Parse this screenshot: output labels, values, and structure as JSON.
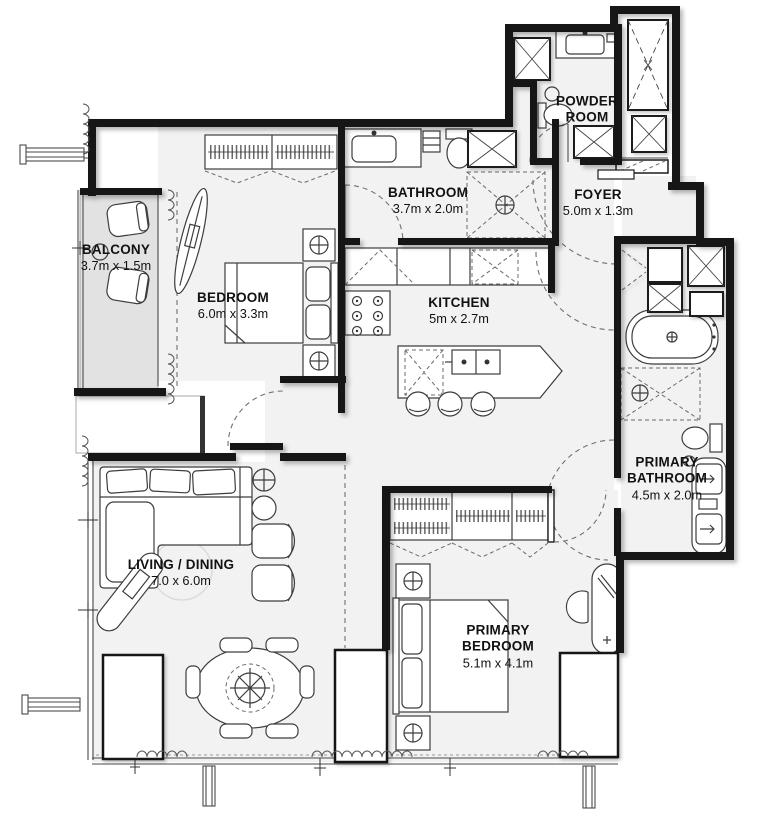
{
  "plan": {
    "title": "Apartment floor plan",
    "rooms": [
      {
        "id": "balcony",
        "name": "BALCONY",
        "dims": "3.7m x 1.5m"
      },
      {
        "id": "bedroom",
        "name": "BEDROOM",
        "dims": "6.0m x 3.3m"
      },
      {
        "id": "bathroom",
        "name": "BATHROOM",
        "dims": "3.7m x 2.0m"
      },
      {
        "id": "kitchen",
        "name": "KITCHEN",
        "dims": "5m x 2.7m"
      },
      {
        "id": "powder-room",
        "name": "POWDER ROOM",
        "dims": ""
      },
      {
        "id": "foyer",
        "name": "FOYER",
        "dims": "5.0m x 1.3m"
      },
      {
        "id": "primary-bathroom",
        "name": "PRIMARY BATHROOM",
        "dims": "4.5m x 2.0m"
      },
      {
        "id": "living-dining",
        "name": "LIVING / DINING",
        "dims": "7.0 x 6.0m"
      },
      {
        "id": "primary-bedroom",
        "name": "PRIMARY BEDROOM",
        "dims": "5.1m x 4.1m"
      }
    ],
    "colors": {
      "wall": "#161616",
      "floor": "#f2f2f2",
      "balcony_floor": "#e2e2e2",
      "furniture_line": "#3d3d3d",
      "dash_line": "#707070",
      "background": "#ffffff"
    }
  }
}
